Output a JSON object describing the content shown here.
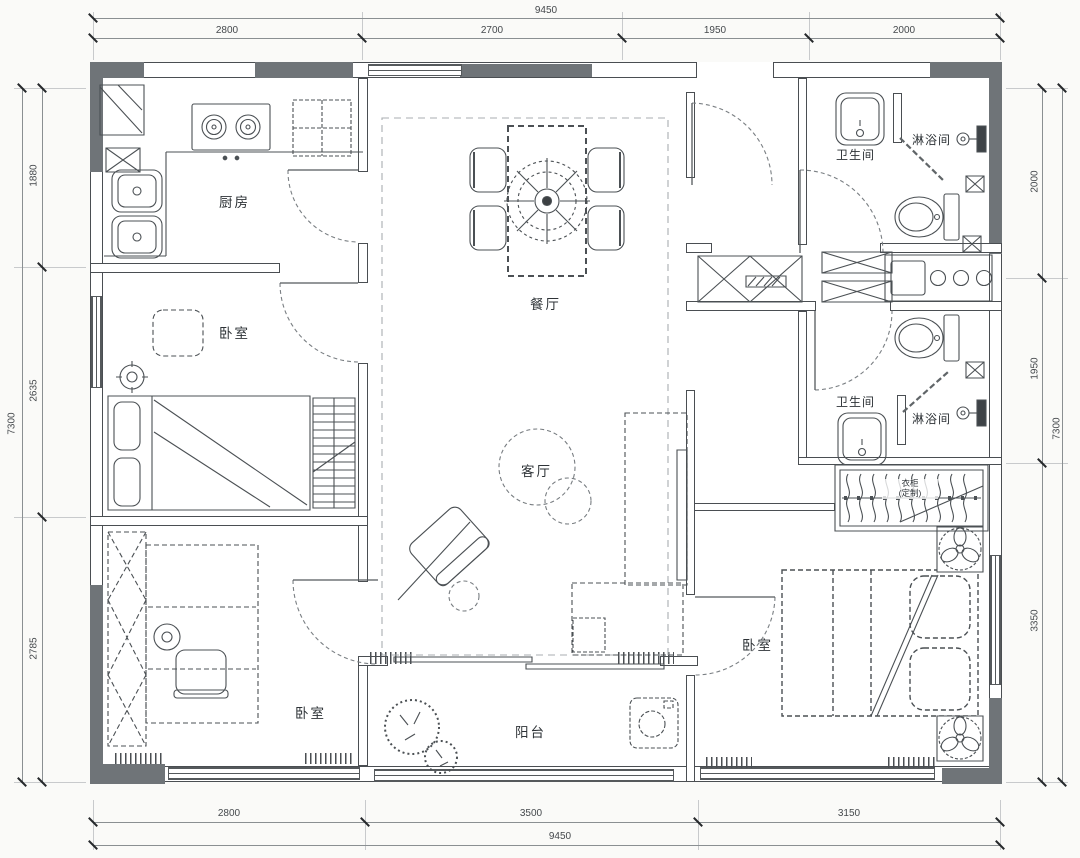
{
  "rooms": {
    "kitchen": {
      "label": "厨房"
    },
    "bedroom_left": {
      "label": "卧室"
    },
    "bedroom_bottom_left": {
      "label": "卧室"
    },
    "bedroom_master": {
      "label": "卧室"
    },
    "dining": {
      "label": "餐厅"
    },
    "living": {
      "label": "客厅"
    },
    "balcony": {
      "label": "阳台"
    },
    "bathroom_top": {
      "label": "卫生间"
    },
    "shower_top": {
      "label": "淋浴间"
    },
    "bathroom_mid": {
      "label": "卫生间"
    },
    "shower_mid": {
      "label": "淋浴间"
    },
    "wardrobe": {
      "label_line1": "衣柜",
      "label_line2": "(定制)"
    }
  },
  "dimensions": {
    "top": {
      "total": "9450",
      "segments": [
        "2800",
        "2700",
        "1950",
        "2000"
      ]
    },
    "bottom": {
      "total": "9450",
      "segments": [
        "2800",
        "3500",
        "3150"
      ]
    },
    "left": {
      "total": "7300",
      "segments": [
        "1880",
        "2635",
        "2785"
      ]
    },
    "right": {
      "total": "7300",
      "segments": [
        "2000",
        "1950",
        "3350"
      ]
    }
  },
  "colors": {
    "line": "#4a4e52",
    "wall_fill": "#6f7478",
    "paper": "#fafaf8"
  }
}
